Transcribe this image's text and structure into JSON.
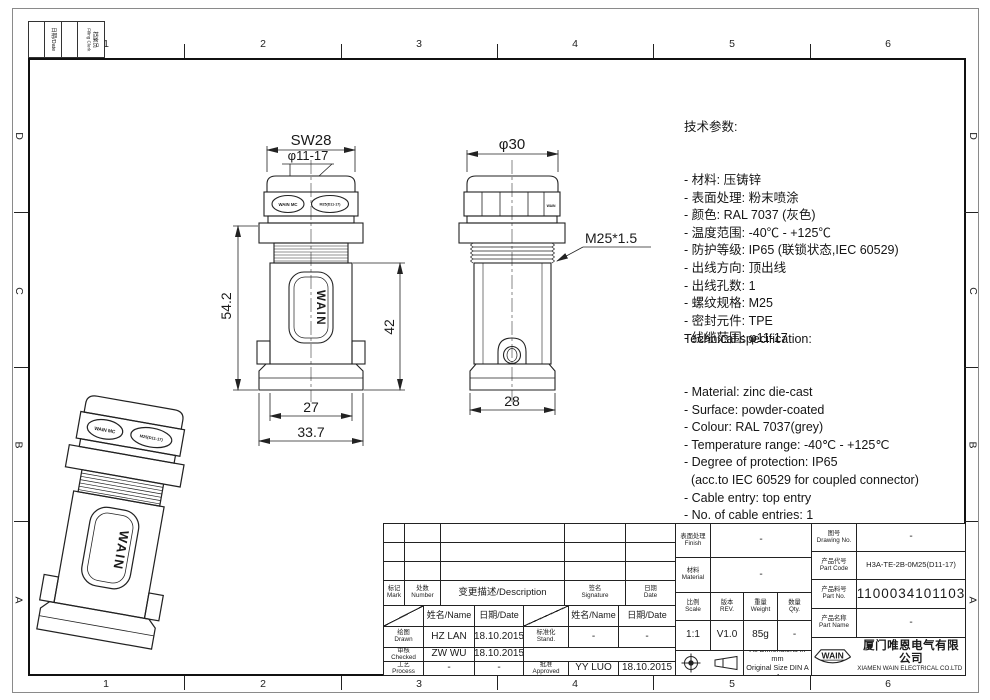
{
  "sheet": {
    "zones": {
      "cols": [
        "1",
        "2",
        "3",
        "4",
        "5",
        "6"
      ],
      "rows": [
        "D",
        "C",
        "B",
        "A"
      ]
    },
    "filing": {
      "date_label": "日期/Date",
      "clerk_zh": "档案员",
      "clerk_en": "Filing Clerk"
    }
  },
  "views": {
    "front": {
      "brand": "WAIN",
      "gland_left": "WAIN MC",
      "gland_right": "M25(D11-17)",
      "dims": {
        "width_flats": "SW28",
        "cable_range": "φ11-17",
        "height_total": "54.2",
        "height_body": "42",
        "width_body": "27",
        "width_base": "33.7"
      }
    },
    "side": {
      "nut_mark": "WAIN",
      "dims": {
        "diameter": "φ30",
        "thread": "M25*1.5",
        "width_base": "28"
      }
    }
  },
  "specs_zh": {
    "title": "技术参数:",
    "items": [
      "- 材料: 压铸锌",
      "- 表面处理: 粉末喷涂",
      "- 颜色: RAL 7037 (灰色)",
      "- 温度范围: -40℃ - +125℃",
      "- 防护等级: IP65 (联锁状态,IEC 60529)",
      "- 出线方向: 顶出线",
      "- 出线孔数: 1",
      "- 螺纹规格: M25",
      "- 密封元件: TPE",
      "- 线缆范围: φ11-17"
    ]
  },
  "specs_en": {
    "title": "Technical specification:",
    "items": [
      "- Material: zinc die-cast",
      "- Surface: powder-coated",
      "- Colour: RAL 7037(grey)",
      "- Temperature range: -40℃ - +125℃",
      "- Degree of protection: IP65",
      "  (acc.to IEC 60529 for coupled connector)",
      "- Cable entry: top entry",
      "- No. of cable entries: 1",
      "- Thread size: M25",
      "- Hoods/Housings sealing: TPE",
      "- Wire range: φ11-17"
    ]
  },
  "title_block": {
    "revision": {
      "mark_zh": "标记",
      "mark_en": "Mark",
      "number_zh": "处数",
      "number_en": "Number",
      "description": "变更描述/Description",
      "signature_zh": "签名",
      "signature_en": "Signature",
      "date_zh": "日期",
      "date_en": "Date"
    },
    "personnel": {
      "name_header": "姓名/Name",
      "date_header": "日期/Date",
      "rows": [
        {
          "role_zh": "绘图",
          "role_en": "Drawn",
          "name": "HZ LAN",
          "date": "18.10.2015",
          "role2_zh": "标准化",
          "role2_en": "Stand.",
          "name2": "-",
          "date2": "-"
        },
        {
          "role_zh": "审核",
          "role_en": "Checked",
          "name": "ZW WU",
          "date": "18.10.2015",
          "role2_zh": "",
          "role2_en": "",
          "name2": "",
          "date2": ""
        },
        {
          "role_zh": "工艺",
          "role_en": "Process",
          "name": "-",
          "date": "-",
          "role2_zh": "批准",
          "role2_en": "Approved",
          "name2": "YY LUO",
          "date2": "18.10.2015"
        }
      ]
    },
    "info": {
      "finish_zh": "表面处理",
      "finish_en": "Finish",
      "finish_value": "-",
      "material_zh": "材料",
      "material_en": "Material",
      "material_value": "-",
      "scale_zh": "比例",
      "scale_en": "Scale",
      "scale_value": "1:1",
      "rev_zh": "版本",
      "rev_en": "REV.",
      "rev_value": "V1.0",
      "weight_zh": "重量",
      "weight_en": "Weight",
      "weight_value": "85g",
      "qty_zh": "数量",
      "qty_en": "Qty.",
      "qty_value": "-",
      "note1": "All Dimensions in mm",
      "note2": "Original Size DIN A 4"
    },
    "part": {
      "drawing_no_zh": "图号",
      "drawing_no_en": "Drawing No.",
      "drawing_no_value": "-",
      "part_code_zh": "产品代号",
      "part_code_en": "Part Code",
      "part_code_value": "H3A-TE-2B-0M25(D11-17)",
      "part_no_zh": "产品料号",
      "part_no_en": "Part No.",
      "part_no_value": "1100034101103",
      "part_name_zh": "产品名称",
      "part_name_en": "Part Name",
      "part_name_value": "-"
    },
    "company": {
      "logo": "WAIN",
      "zh": "厦门唯恩电气有限公司",
      "en": "XIAMEN WAIN ELECTRICAL CO.LTD"
    }
  }
}
